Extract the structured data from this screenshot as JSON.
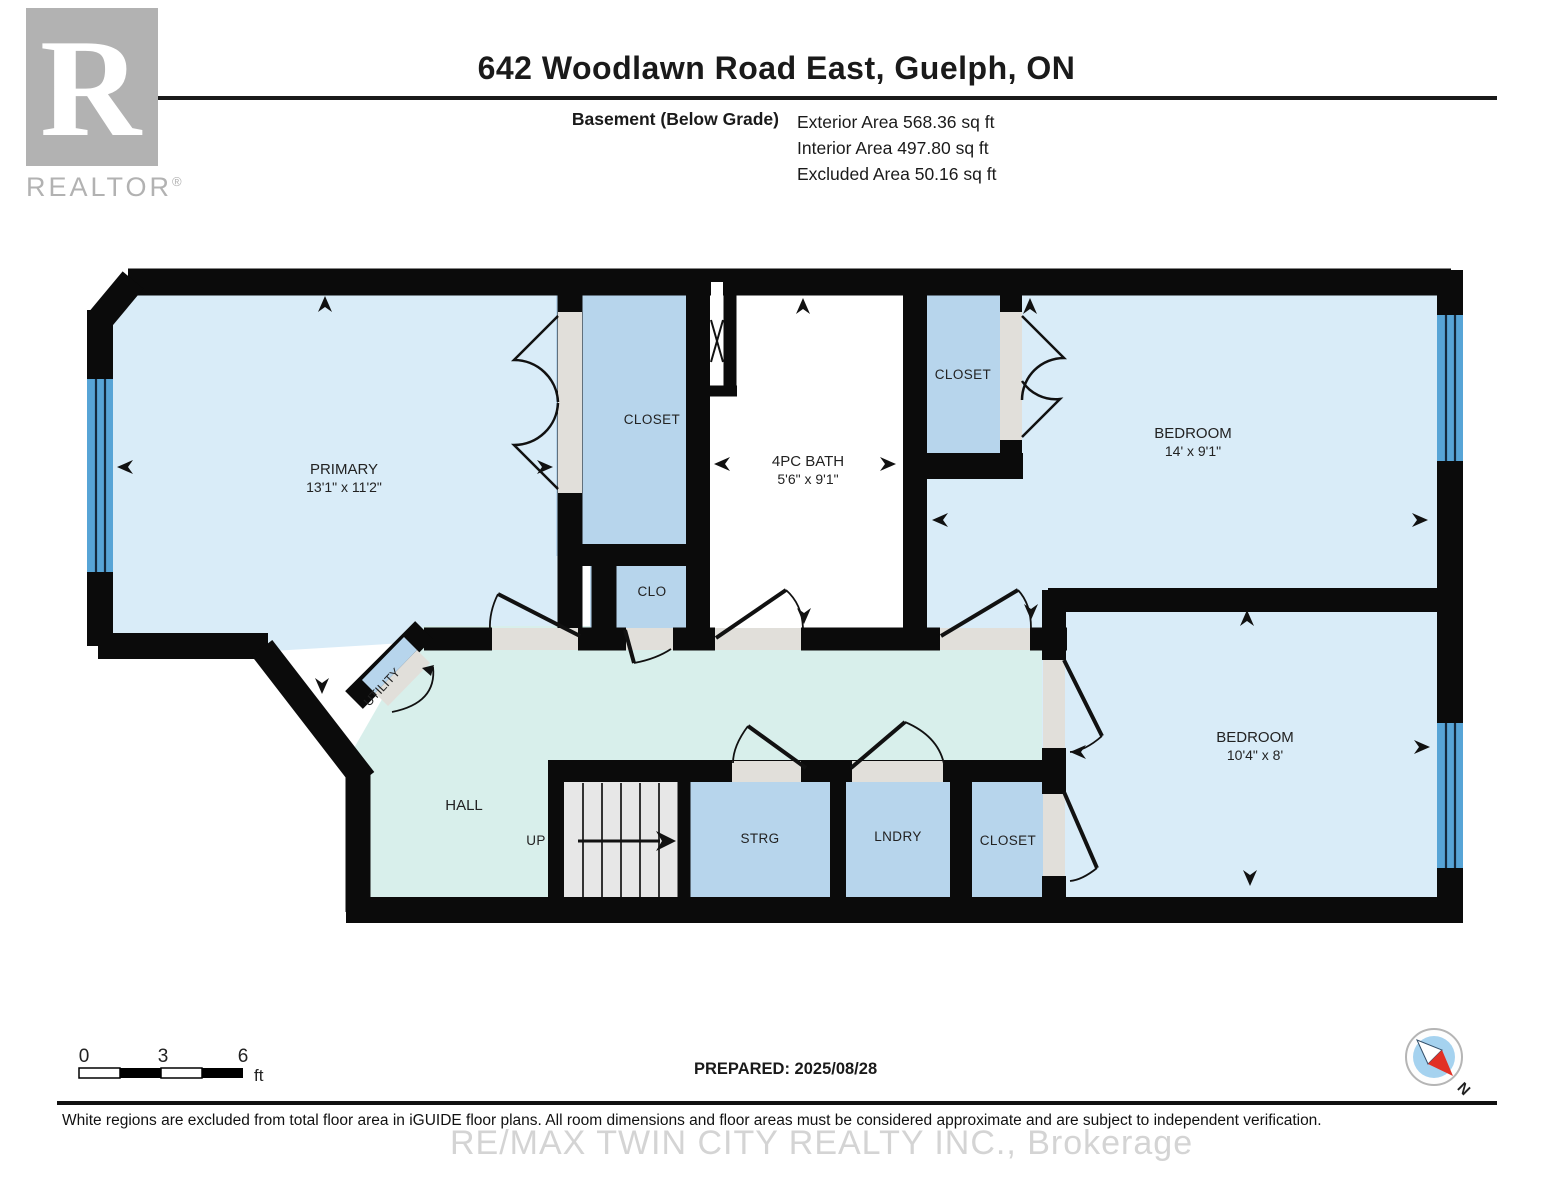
{
  "header": {
    "title": "642 Woodlawn Road East, Guelph, ON",
    "floor_label": "Basement (Below Grade)",
    "areas": [
      "Exterior Area 568.36 sq ft",
      "Interior Area 497.80 sq ft",
      "Excluded Area 50.16 sq ft"
    ]
  },
  "logo": {
    "letter": "R",
    "wordmark": "REALTOR",
    "registered": "®"
  },
  "rooms": {
    "primary": {
      "name": "PRIMARY",
      "dims": "13'1\" x 11'2\""
    },
    "closet_top": {
      "name": "CLOSET"
    },
    "clo": {
      "name": "CLO"
    },
    "bath": {
      "name": "4PC BATH",
      "dims": "5'6\" x 9'1\""
    },
    "closet_right": {
      "name": "CLOSET"
    },
    "bedroom_top": {
      "name": "BEDROOM",
      "dims": "14' x 9'1\""
    },
    "bedroom_bottom": {
      "name": "BEDROOM",
      "dims": "10'4\" x 8'"
    },
    "hall": {
      "name": "HALL"
    },
    "utility": {
      "name": "UTILITY"
    },
    "storage": {
      "name": "STRG"
    },
    "laundry": {
      "name": "LNDRY"
    },
    "closet_bottom": {
      "name": "CLOSET"
    },
    "stairs": {
      "label": "UP"
    }
  },
  "scale_bar": {
    "ticks": [
      "0",
      "3",
      "6"
    ],
    "unit": "ft"
  },
  "compass": {
    "north": "N"
  },
  "footer": {
    "prepared": "PREPARED: 2025/08/28",
    "disclaimer": "White regions are excluded from total floor area in iGUIDE floor plans. All room dimensions and floor areas must be considered approximate and are subject to independent verification.",
    "watermark": "RE/MAX TWIN CITY REALTY INC., Brokerage"
  }
}
